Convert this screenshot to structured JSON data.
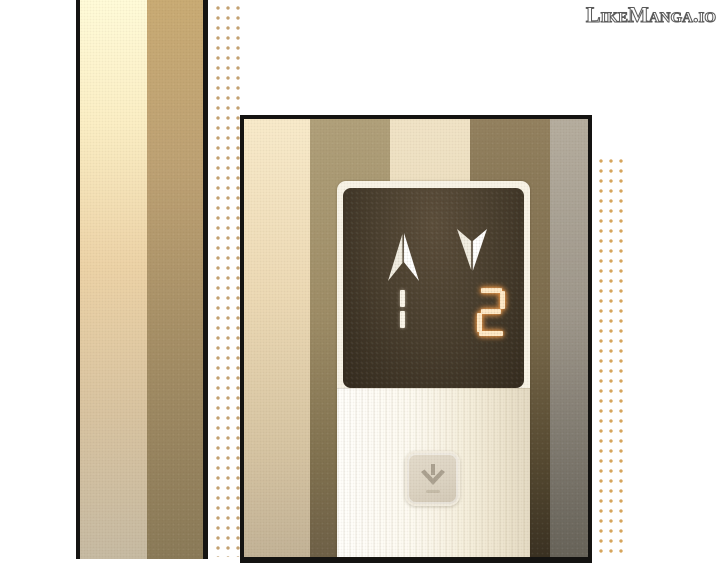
{
  "watermark": {
    "text": "LikeManga.io"
  },
  "panel": {
    "indicator": {
      "up_arrow_icon": "up-arrow",
      "down_arrow_icon": "down-arrow",
      "left_floor_value": "1",
      "right_floor_value": "2",
      "active_side": "down"
    },
    "call_button": {
      "icon": "down-arrow"
    }
  },
  "colors": {
    "screen_background": "#4a3f2f",
    "digit_left": "#faf5e9",
    "digit_right_core": "#ffe9c6",
    "digit_right_glow": "#d9893f",
    "halftone_dots_mid": "#c3a171",
    "halftone_dots_right": "#d6a55c",
    "panel_border": "#141311"
  }
}
